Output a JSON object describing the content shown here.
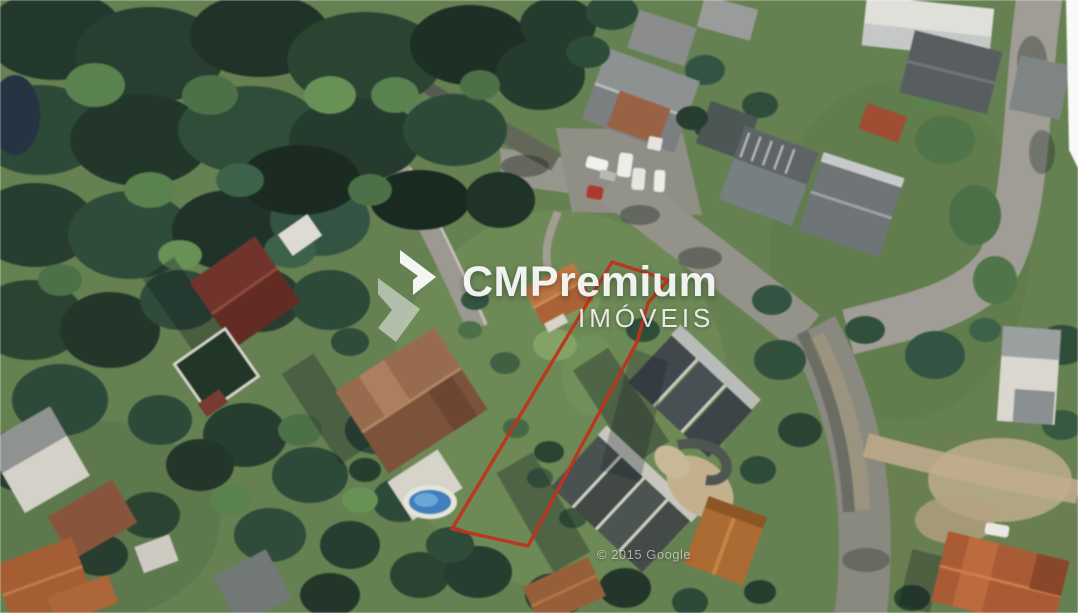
{
  "watermark": {
    "brand": "CMPremium",
    "subtitle": "IMÓVEIS"
  },
  "map": {
    "credit": "© 2015 Google",
    "lot_boundary": {
      "color": "#c0331d",
      "points": "612,262 668,280 648,303 637,342 528,546 452,529"
    }
  }
}
